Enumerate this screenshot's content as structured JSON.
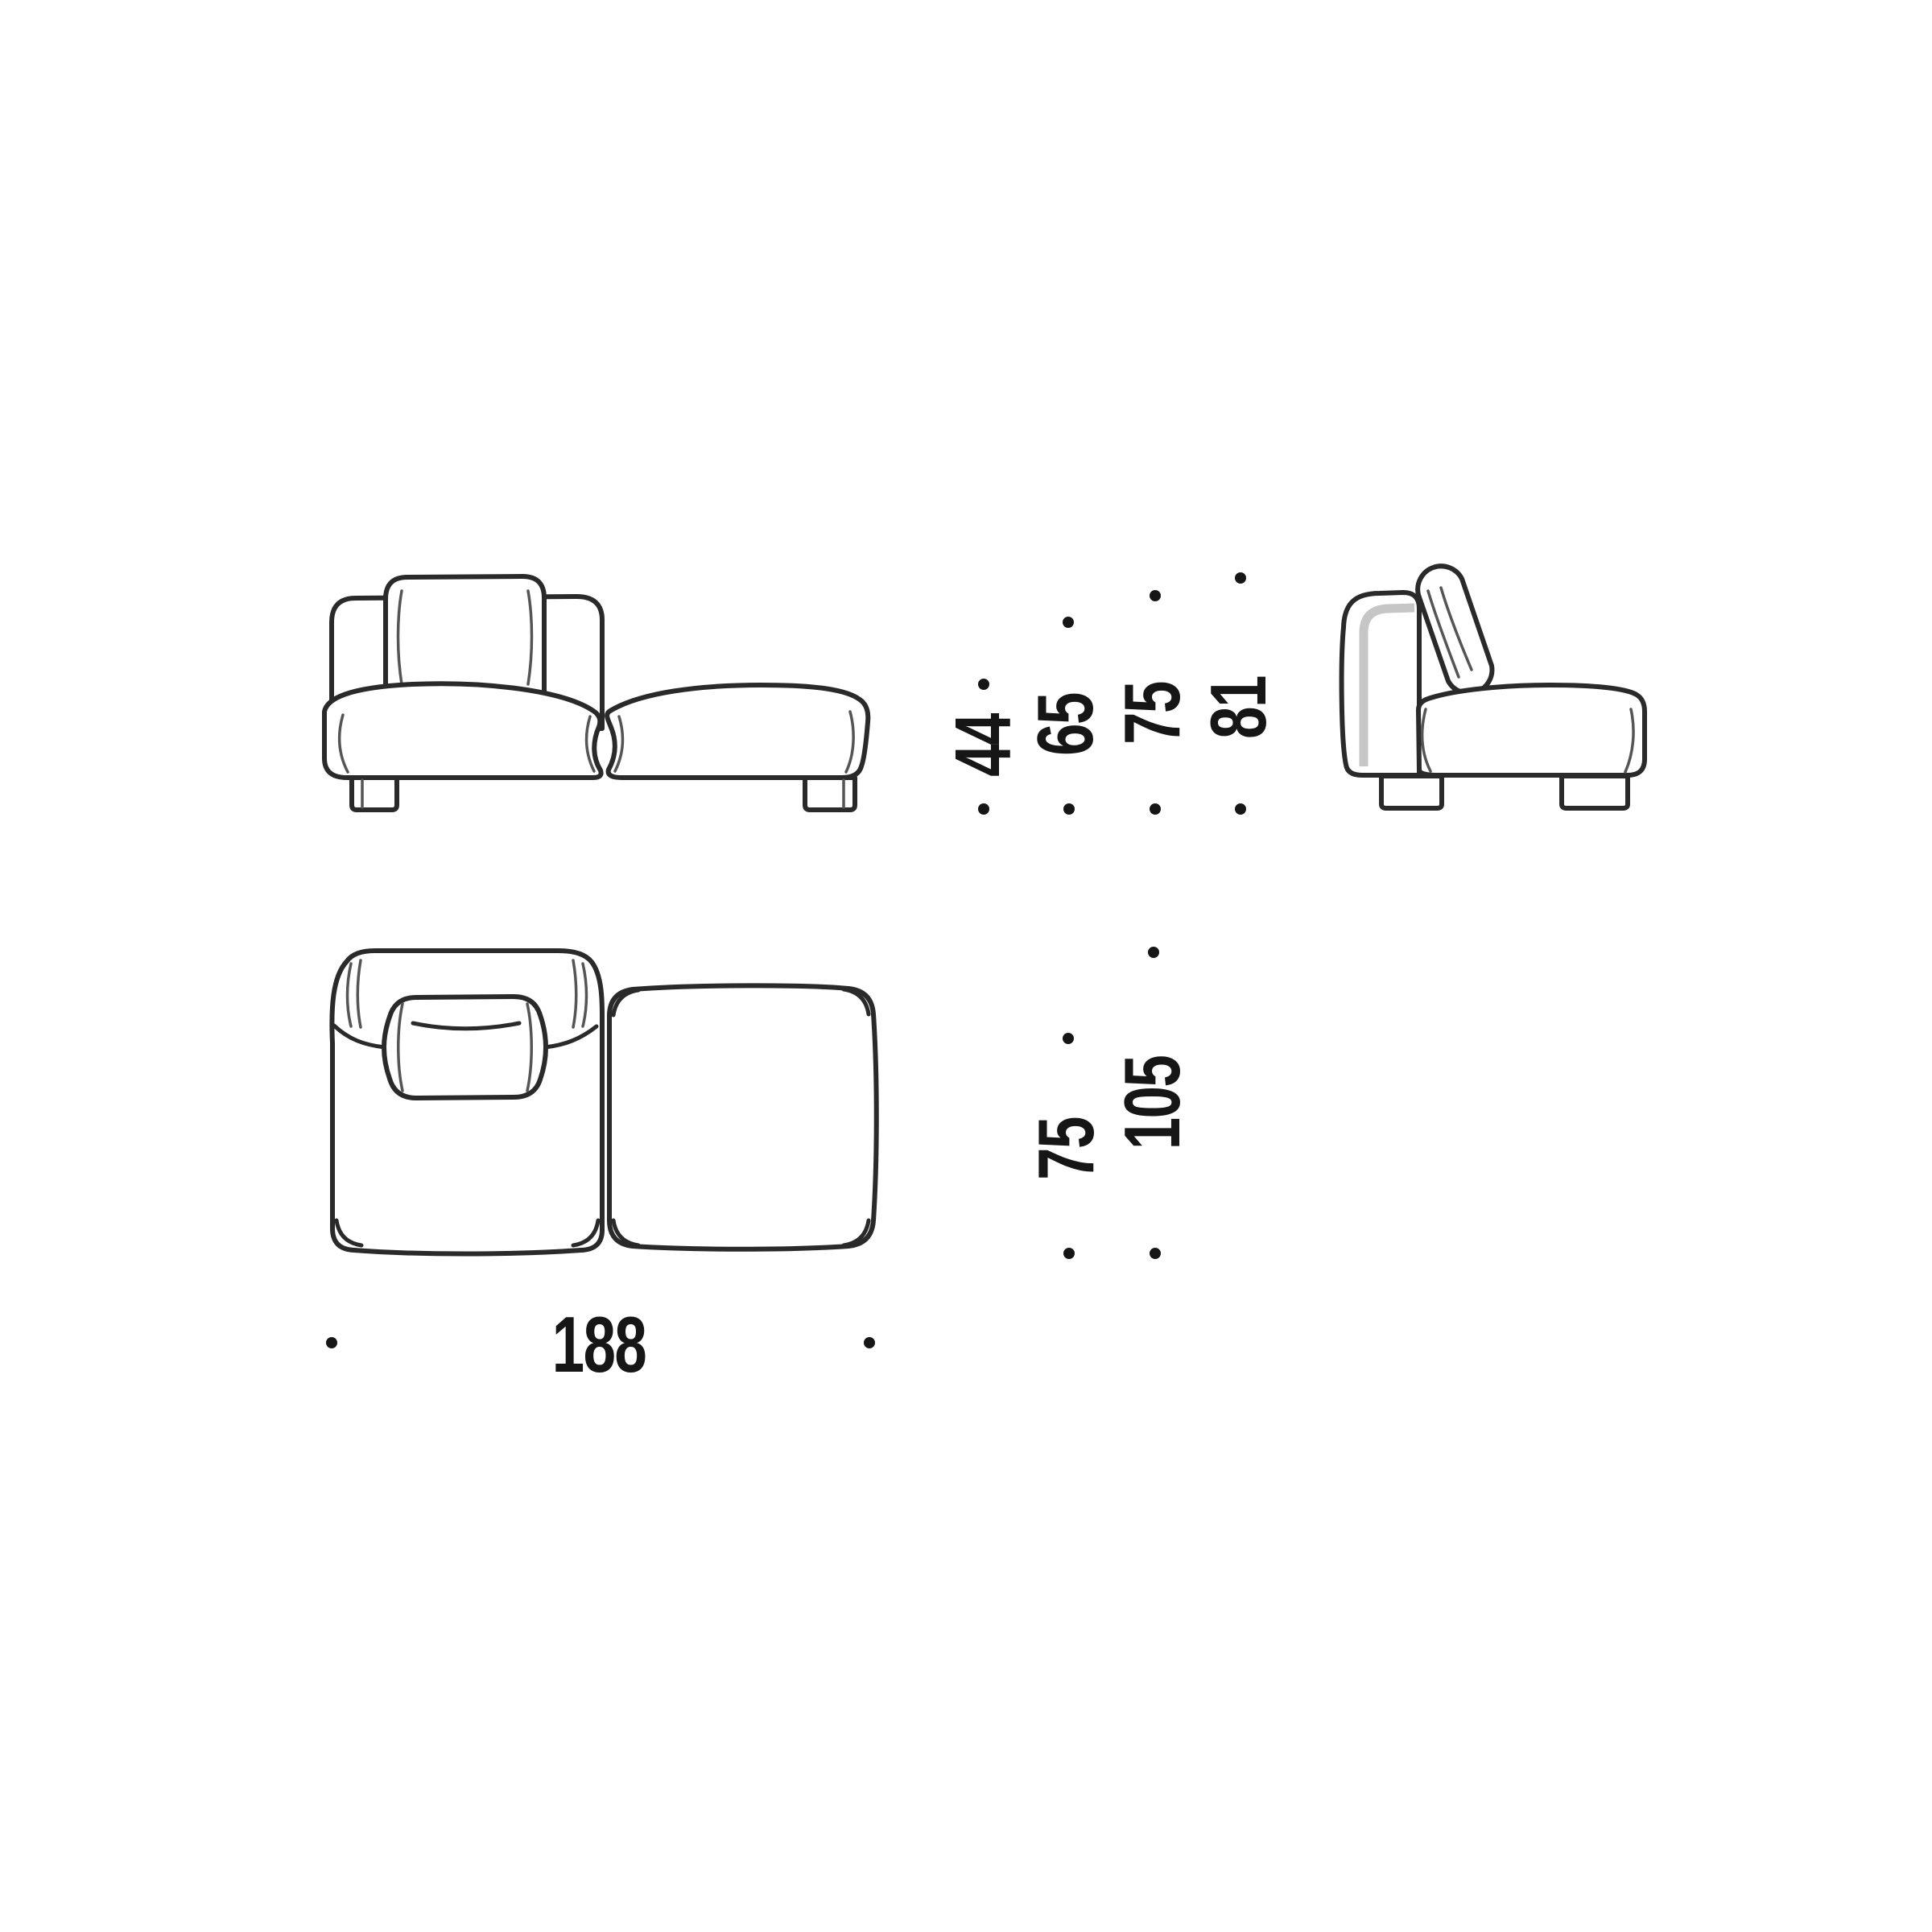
{
  "dimensions": {
    "front_view_heights": [
      "44",
      "65",
      "75",
      "81"
    ],
    "plan_view_depths": [
      "75",
      "105"
    ],
    "overall_width": "188"
  },
  "colors": {
    "line": "#2a2a2a",
    "seam": "#555555",
    "panel_shadow": "#c6c6c6",
    "label": "#161616",
    "background": "#ffffff"
  }
}
